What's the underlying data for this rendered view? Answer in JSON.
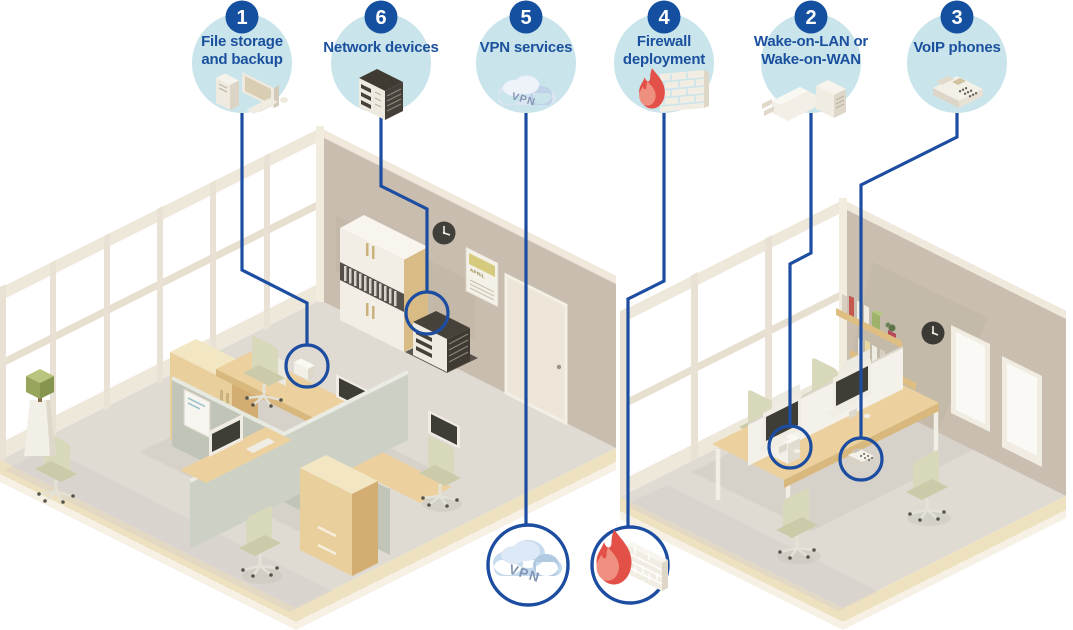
{
  "callouts": [
    {
      "number": "1",
      "label_lines": [
        "File storage",
        "and backup"
      ],
      "icon": "desktop-computer-icon"
    },
    {
      "number": "6",
      "label_lines": [
        "Network devices"
      ],
      "icon": "server-icon"
    },
    {
      "number": "5",
      "label_lines": [
        "VPN services"
      ],
      "icon": "vpn-cloud-icon",
      "cloud_text": "VPN"
    },
    {
      "number": "4",
      "label_lines": [
        "Firewall",
        "deployment"
      ],
      "icon": "firewall-icon"
    },
    {
      "number": "2",
      "label_lines": [
        "Wake-on-LAN or",
        "Wake-on-WAN"
      ],
      "icon": "power-plug-icon"
    },
    {
      "number": "3",
      "label_lines": [
        "VoIP phones"
      ],
      "icon": "voip-phone-icon"
    }
  ],
  "bottom_markers": {
    "vpn_circle": {
      "icon": "vpn-cloud-icon",
      "text": "VPN"
    },
    "firewall_circle": {
      "icon": "firewall-icon"
    }
  },
  "left_room": {
    "calendar_month": "APRIL"
  },
  "colors": {
    "accent_blue": "#1c4da1",
    "badge_blue": "#14509f",
    "label_blue": "#1b509f",
    "bubble_fill": "#c9e4ea",
    "flame_red": "#e25048",
    "flame_light": "#ef8f80",
    "cloud_blue": "#c6daee",
    "cloud_shade": "#b2c9e2",
    "wall_taupe": "#c8bdae",
    "window_frame": "#eee8db",
    "floor_gray": "#dfdbd3",
    "platform_cream": "#eee1bf",
    "wood_tan": "#ecd19e",
    "cabinet_tan": "#e9cf9b",
    "partition_gray": "#c4c8bb",
    "monitor_dark": "#3e3e37",
    "chair_olive": "#d8d8bb"
  }
}
